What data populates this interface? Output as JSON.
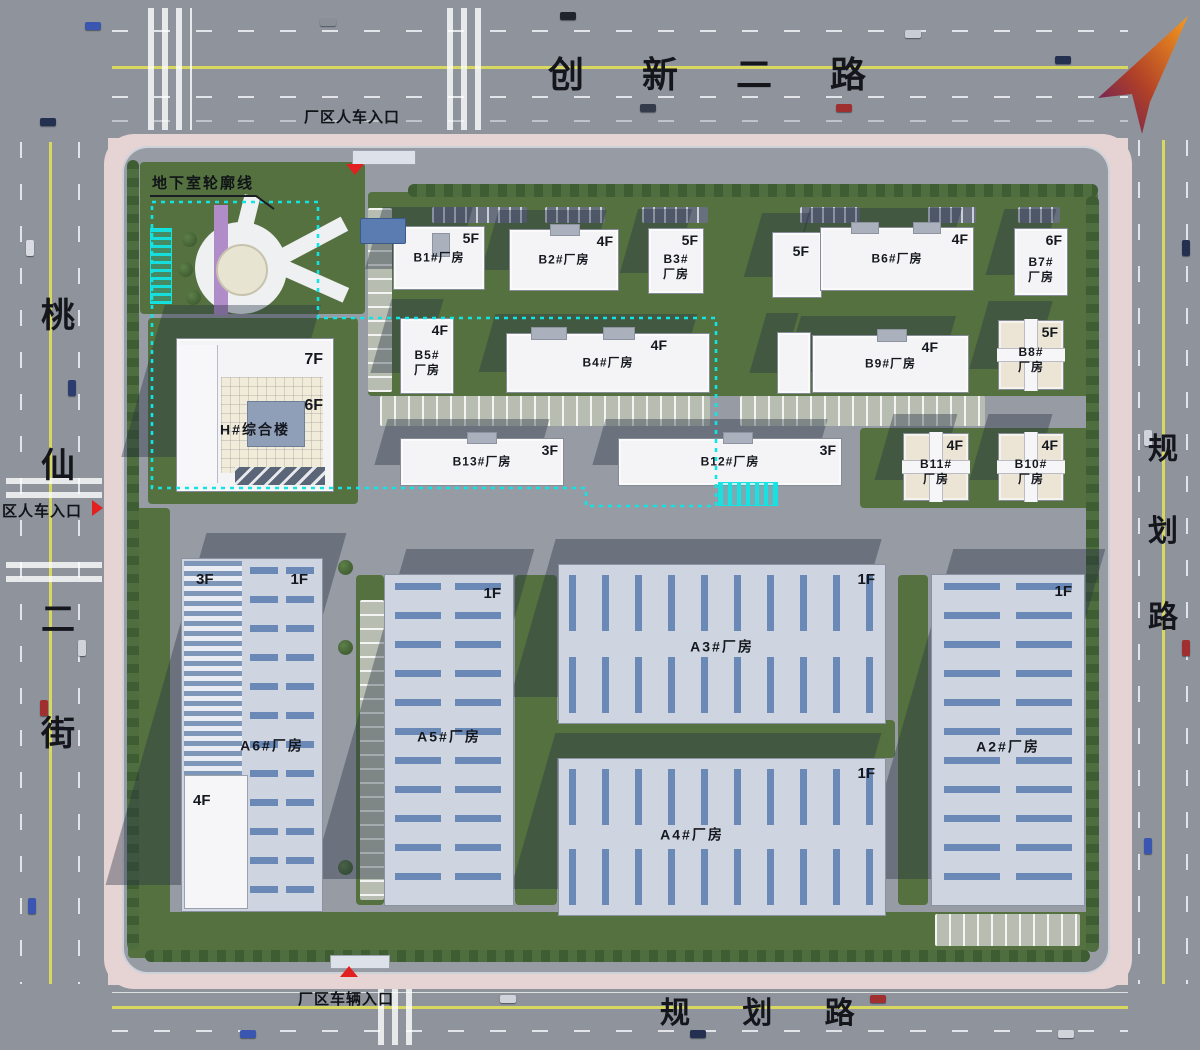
{
  "roads": {
    "top": {
      "name": "创 新 二 路"
    },
    "bottom": {
      "name": "规 划 路"
    },
    "left": {
      "chars": [
        "桃",
        "仙",
        "二",
        "街"
      ]
    },
    "right": {
      "chars": [
        "规",
        "划",
        "路"
      ]
    }
  },
  "entrances": {
    "top": "厂区人车入口",
    "left": "区人车入口",
    "bottom": "厂区车辆入口"
  },
  "annotations": {
    "basement_outline": "地下室轮廓线"
  },
  "buildings": {
    "b1": {
      "name": "B1#厂房",
      "floor": "5F"
    },
    "b2": {
      "name": "B2#厂房",
      "floor": "4F"
    },
    "b3": {
      "name": "B3#\n厂房",
      "floor": "5F"
    },
    "b6": {
      "name": "B6#厂房",
      "floor": "4F",
      "wing_floor": "5F"
    },
    "b7": {
      "name": "B7#\n厂房",
      "floor": "6F"
    },
    "b5": {
      "name": "B5#\n厂房",
      "floor": "4F"
    },
    "b4": {
      "name": "B4#厂房",
      "floor": "4F"
    },
    "b9": {
      "name": "B9#厂房",
      "floor": "4F"
    },
    "b8": {
      "name": "B8#\n厂房",
      "floor": "5F"
    },
    "b13": {
      "name": "B13#厂房",
      "floor": "3F"
    },
    "b12": {
      "name": "B12#厂房",
      "floor": "3F"
    },
    "b11": {
      "name": "B11#\n厂房",
      "floor": "4F"
    },
    "b10": {
      "name": "B10#\n厂房",
      "floor": "4F"
    },
    "h": {
      "name": "H#综合楼",
      "floor_top": "7F",
      "floor_main": "6F"
    },
    "a6": {
      "name": "A6#厂房",
      "floor_left": "3F",
      "floor_right": "1F",
      "floor_annex": "4F"
    },
    "a5": {
      "name": "A5#厂房",
      "floor": "1F"
    },
    "a3": {
      "name": "A3#厂房",
      "floor": "1F"
    },
    "a4": {
      "name": "A4#厂房",
      "floor": "1F"
    },
    "a2": {
      "name": "A2#厂房",
      "floor": "1F"
    }
  },
  "colors": {
    "basement_dash": "#12e4e4",
    "entrance_marker": "#e32020",
    "road_centerline": "#d8d75f",
    "compass_orange": "#f59a1e",
    "compass_purple": "#5c1b66"
  }
}
